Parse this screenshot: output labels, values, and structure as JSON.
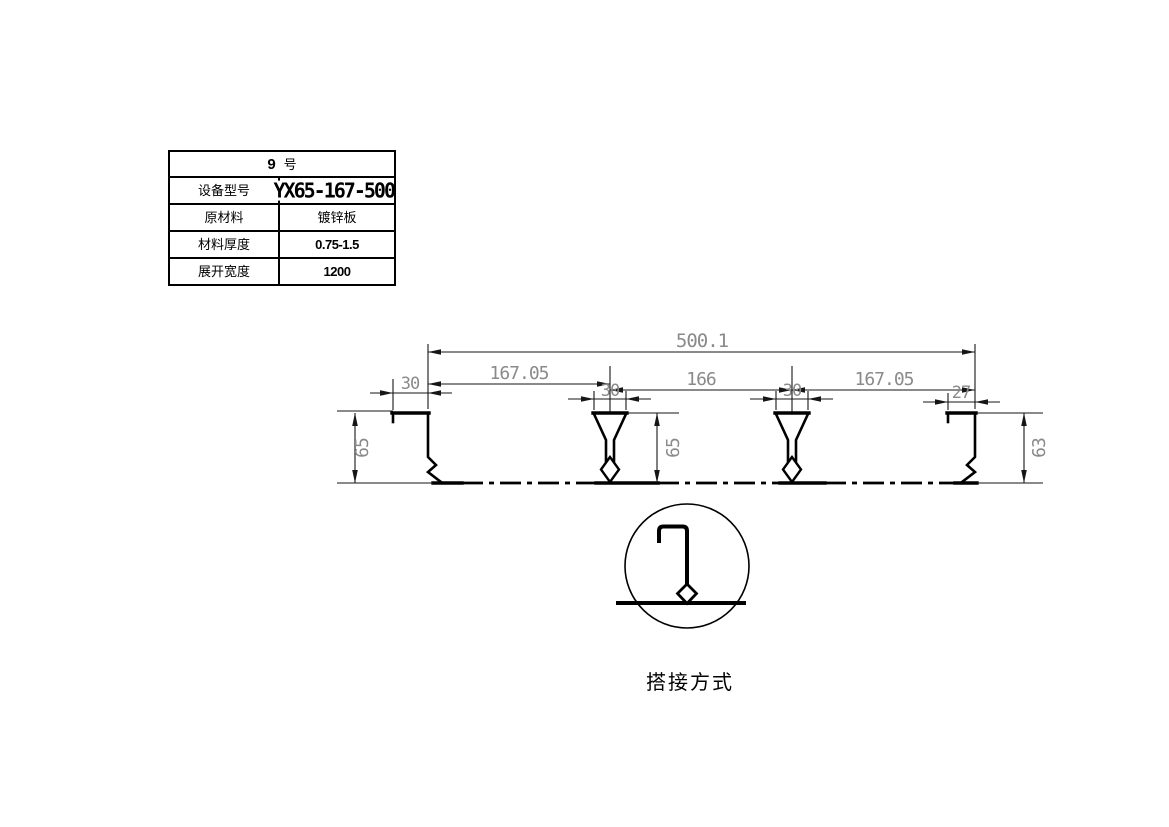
{
  "table": {
    "header_number": "9",
    "header_suffix": "号",
    "rows": [
      {
        "label": "设备型号",
        "value": "YX65-167-500"
      },
      {
        "label": "原材料",
        "value": "镀锌板"
      },
      {
        "label": "材料厚度",
        "value": "0.75-1.5"
      },
      {
        "label": "展开宽度",
        "value": "1200"
      }
    ]
  },
  "dimensions": {
    "overall_width": "500.1",
    "span_left": "167.05",
    "span_middle": "166",
    "span_right": "167.05",
    "left_flange_width": "30",
    "rib1_top_width": "30",
    "rib2_top_width": "30",
    "right_flange_width": "27",
    "left_height": "65",
    "middle_height": "65",
    "right_height": "63"
  },
  "detail": {
    "caption": "搭接方式"
  },
  "colors": {
    "line": "#000000",
    "dimension_text": "#8a8a8a",
    "background": "#ffffff"
  }
}
